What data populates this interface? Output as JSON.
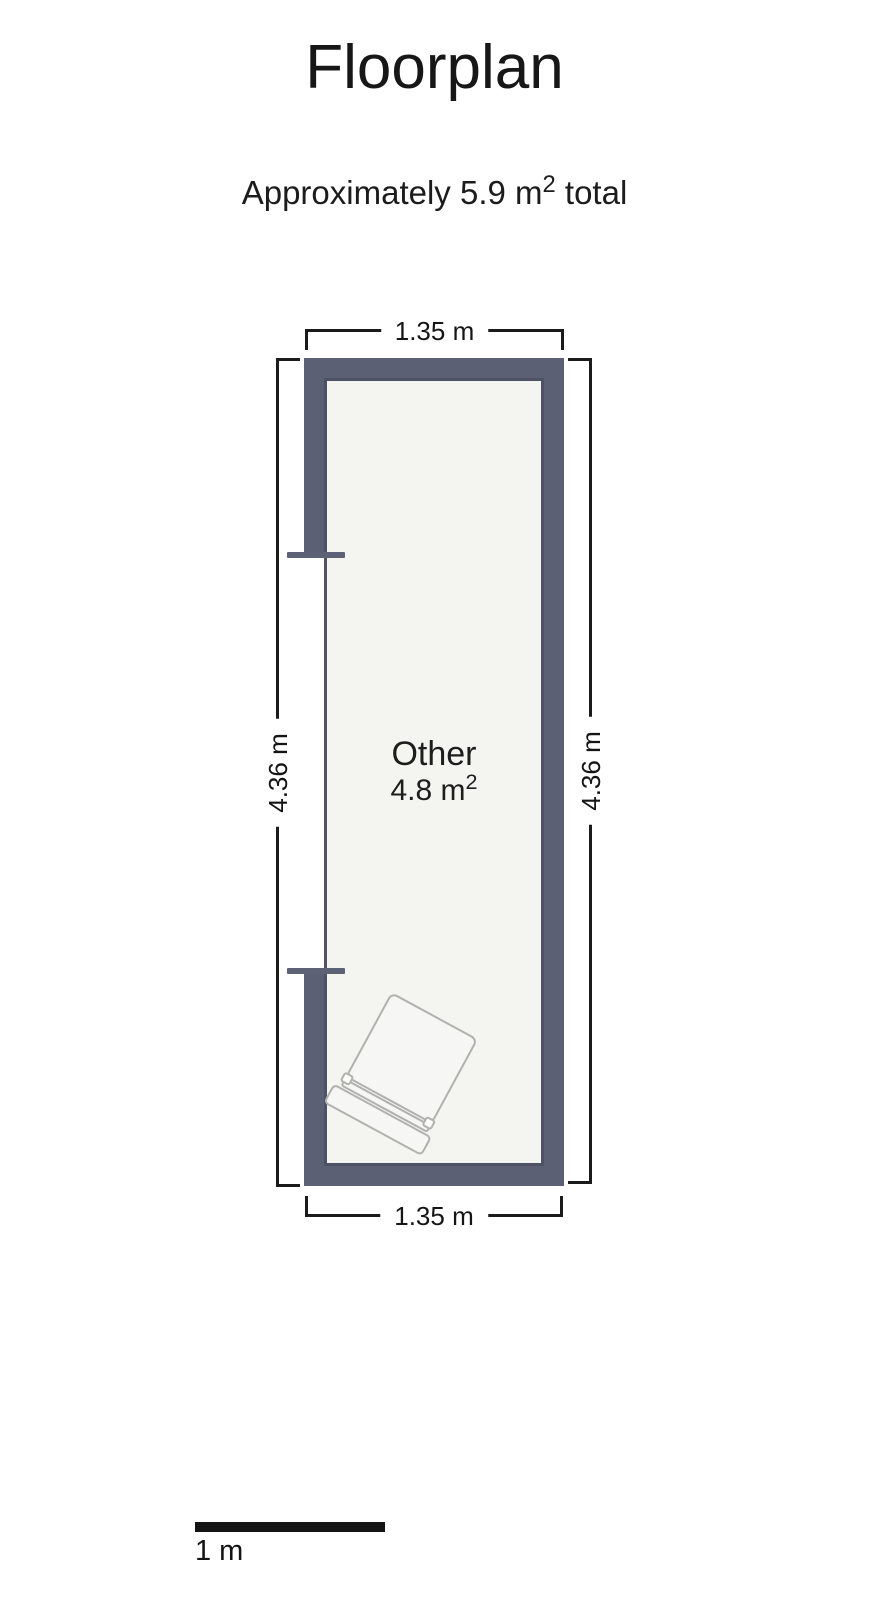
{
  "header": {
    "title": "Floorplan",
    "subtitle": {
      "prefix": "Approximately 5.9 m",
      "sup": "2",
      "suffix": " total"
    }
  },
  "floorplan": {
    "room": {
      "name": "Other",
      "area": {
        "value": "4.8 m",
        "sup": "2"
      }
    },
    "dimensions": {
      "top": "1.35 m",
      "bottom": "1.35 m",
      "left": "4.36 m",
      "right": "4.36 m"
    },
    "furniture": [
      {
        "name": "bed"
      }
    ],
    "colors": {
      "wall": "#5b6074",
      "wall_inner_edge": "#4d5266",
      "floor": "#f4f4f1",
      "dimension_line": "#1b1b1b",
      "furniture_outline": "#b1b1ae",
      "background": "#ffffff"
    }
  },
  "scale_bar": {
    "label": "1 m"
  }
}
